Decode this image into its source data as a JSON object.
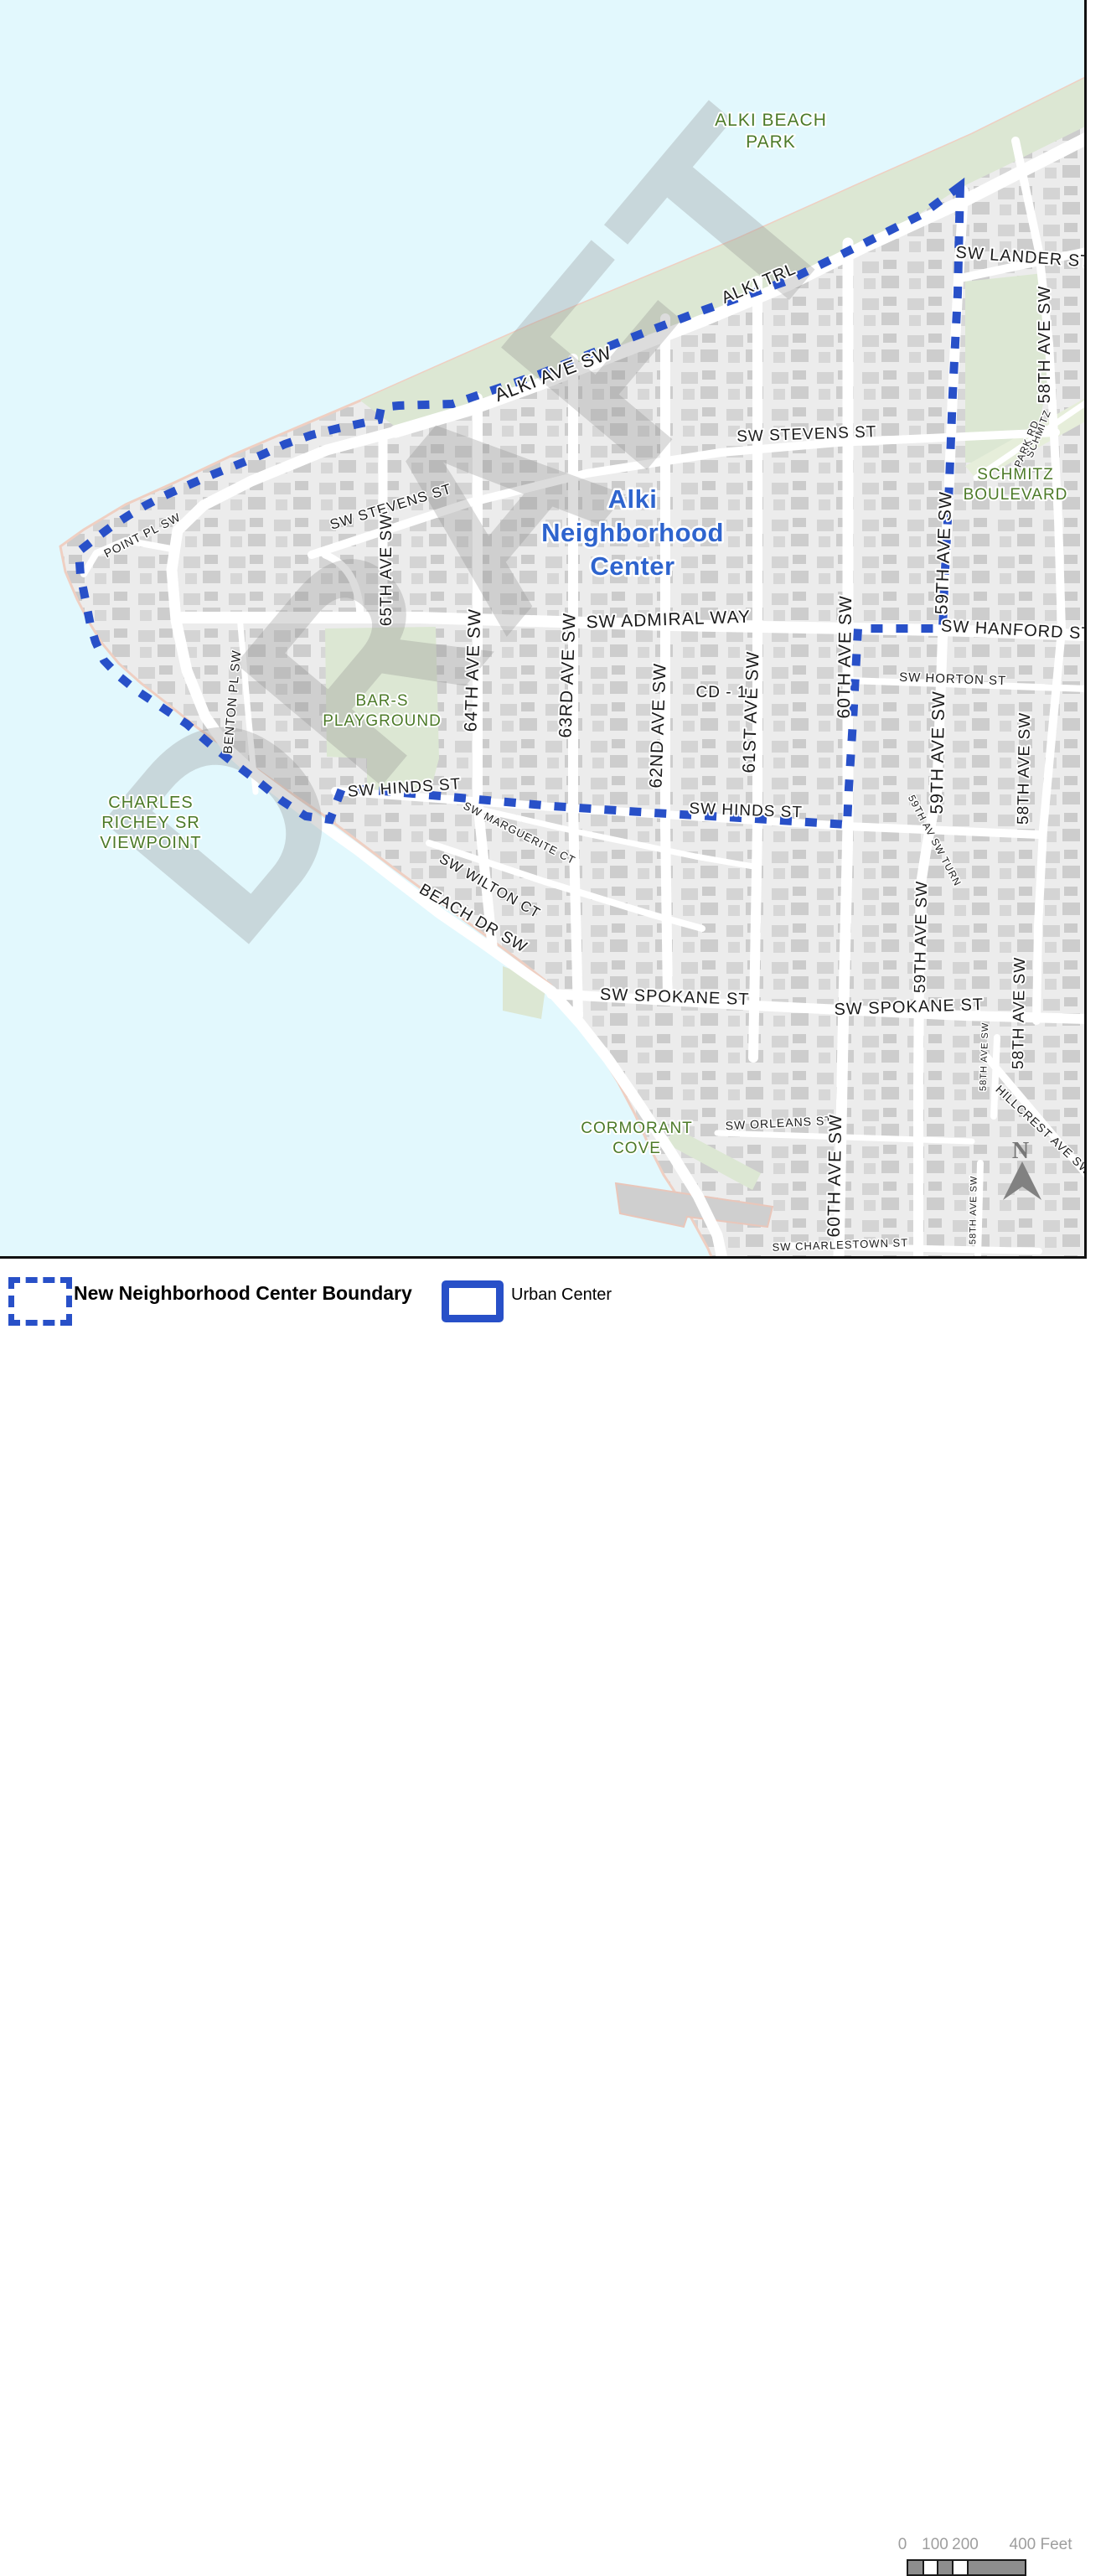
{
  "colors": {
    "water": "#E2F8FD",
    "land": "#ECECEC",
    "building": "#D1D1D1",
    "park": "#DCE7D3",
    "park_light": "#E6EEDA",
    "road": "#FFFFFF",
    "shoreline": "#EFCFC2",
    "boundary_blue": "#2850C8",
    "green_label": "#4C7A28",
    "blue_label": "#2E64CE",
    "watermark_gray": "#8E8E8E",
    "scale_gray": "#8D8D8D"
  },
  "map": {
    "watermark": "DRAFT",
    "zone_label": "CD - 1",
    "north_label": "N",
    "center_label": {
      "lines": [
        "Alki",
        "Neighborhood",
        "Center"
      ]
    },
    "parks": [
      {
        "name": "alki-beach-park",
        "lines": [
          "ALKI BEACH",
          "PARK"
        ]
      },
      {
        "name": "schmitz-boulevard",
        "lines": [
          "SCHMITZ",
          "BOULEVARD"
        ]
      },
      {
        "name": "bar-s-playground",
        "lines": [
          "BAR-S",
          "PLAYGROUND"
        ]
      },
      {
        "name": "charles-richey-sr-viewpoint",
        "lines": [
          "CHARLES",
          "RICHEY SR",
          "VIEWPOINT"
        ]
      },
      {
        "name": "cormorant-cove",
        "lines": [
          "CORMORANT",
          "COVE"
        ]
      }
    ],
    "streets": [
      {
        "text": "ALKI TRL"
      },
      {
        "text": "ALKI AVE SW"
      },
      {
        "text": "SW LANDER ST"
      },
      {
        "text": "58TH AVE SW"
      },
      {
        "text": "SCHMITZ"
      },
      {
        "text": "PARK RD"
      },
      {
        "text": "SW STEVENS ST"
      },
      {
        "text": "SW STEVENS ST"
      },
      {
        "text": "65TH AVE SW"
      },
      {
        "text": "64TH AVE SW"
      },
      {
        "text": "63RD AVE SW"
      },
      {
        "text": "SW ADMIRAL WAY"
      },
      {
        "text": "SW HANFORD ST"
      },
      {
        "text": "SW HORTON ST"
      },
      {
        "text": "62ND AVE SW"
      },
      {
        "text": "61ST AVE SW"
      },
      {
        "text": "60TH AVE SW"
      },
      {
        "text": "59TH AVE SW"
      },
      {
        "text": "59TH AVE SW"
      },
      {
        "text": "59TH AV SW TURN"
      },
      {
        "text": "59TH AVE SW"
      },
      {
        "text": "58TH AVE SW"
      },
      {
        "text": "58TH AVE SW"
      },
      {
        "text": "58TH AVE SW"
      },
      {
        "text": "HILLCREST AVE SW"
      },
      {
        "text": "SW SPOKANE ST"
      },
      {
        "text": "SW SPOKANE ST"
      },
      {
        "text": "SW ORLEANS ST"
      },
      {
        "text": "60TH AVE SW"
      },
      {
        "text": "SW CHARLESTOWN ST"
      },
      {
        "text": "58TH AVE SW"
      },
      {
        "text": "POINT PL SW"
      },
      {
        "text": "BENTON PL SW"
      },
      {
        "text": "SW HINDS ST"
      },
      {
        "text": "SW HINDS ST"
      },
      {
        "text": "SW MARGUERITE CT"
      },
      {
        "text": "SW WILTON CT"
      },
      {
        "text": "BEACH DR SW"
      }
    ]
  },
  "legend": {
    "items": [
      {
        "label": "New Neighborhood Center Boundary",
        "style": "dashed-blue-outline"
      },
      {
        "label": "Urban Center",
        "style": "solid-blue-outline"
      }
    ]
  },
  "scale_bar": {
    "ticks": [
      "0",
      "100",
      "200",
      "400 Feet"
    ]
  }
}
